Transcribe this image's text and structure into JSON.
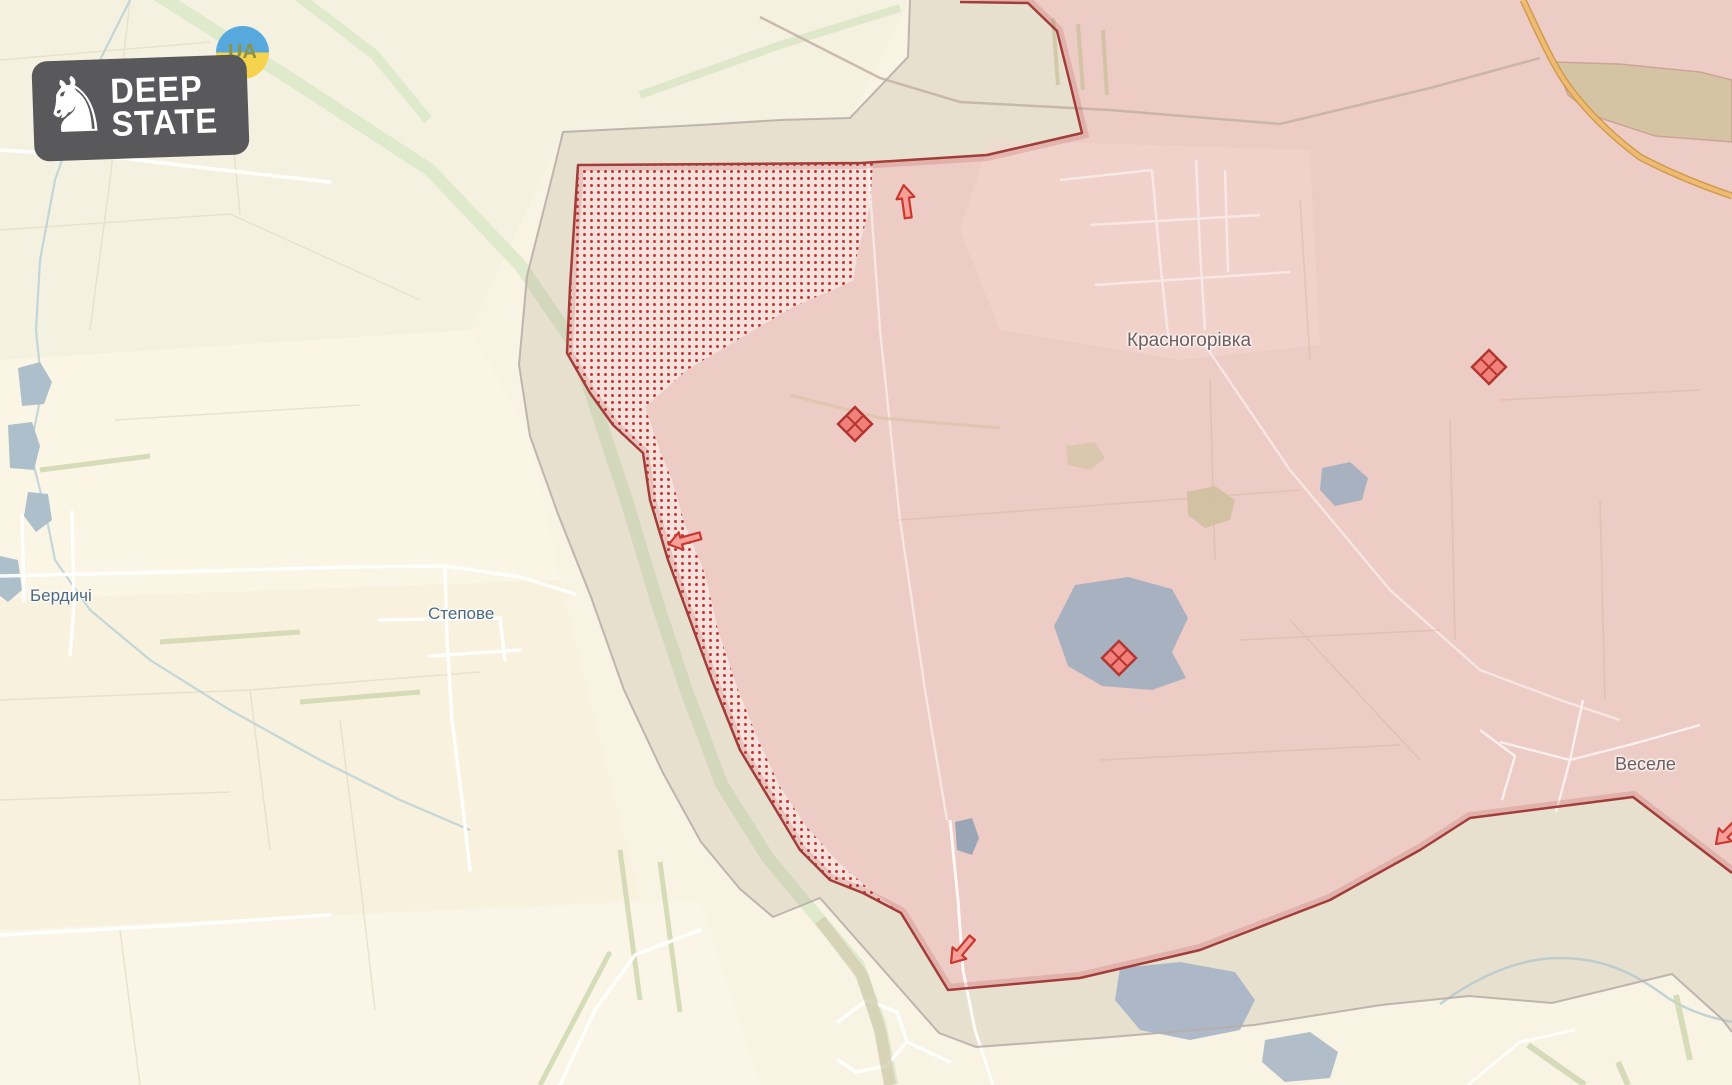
{
  "logo": {
    "line1": "DEEP",
    "line2": "STATE",
    "badge_text": "UA",
    "knight_glyph": "♞"
  },
  "places": {
    "berdychi": "Бердичі",
    "stepove": "Степове",
    "krasnohorivka": "Красногорівка",
    "vesele": "Веселе"
  },
  "map": {
    "colors": {
      "base_background": "#f8f3e2",
      "occupied_fill": "#edccc5",
      "frontline_stroke": "#a23d39",
      "contested_dot": "#c7302d",
      "contested_background": "#f6e2dd",
      "buffer_fill_tint": "rgba(150,122,115,0.16)",
      "buffer_stroke": "#b9aeaa",
      "water_fill": "#a7b1bf",
      "highway_orange": "#eebb72",
      "greenway": "#dde8c9",
      "ua_blue": "#57a9dd",
      "ua_yellow": "#f6d34c",
      "marker_fill": "#f2807b",
      "marker_stroke": "#b23732"
    },
    "markers": {
      "fortification_diamond_count": 3,
      "attack_arrow_count": 4
    }
  }
}
